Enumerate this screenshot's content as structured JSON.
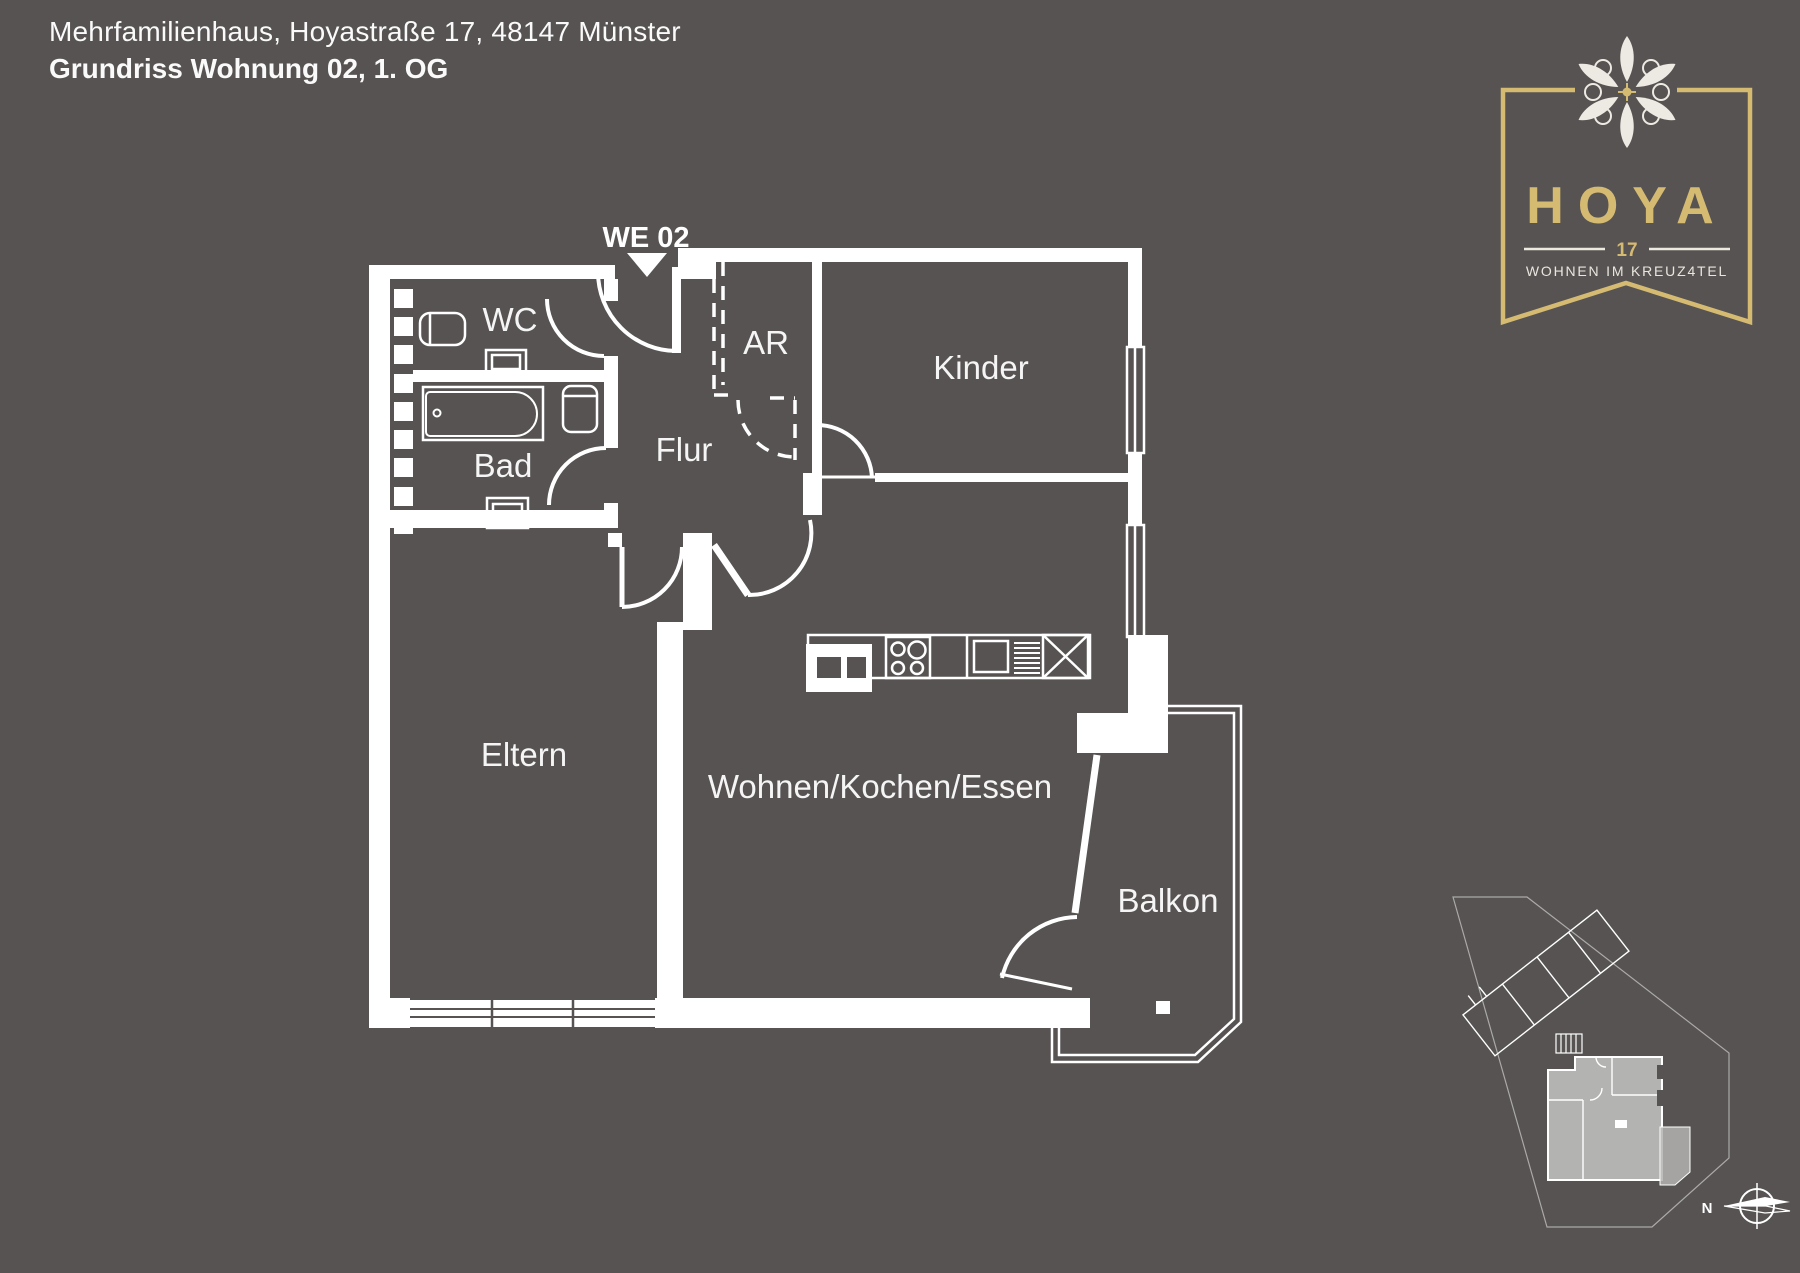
{
  "header": {
    "line1": "Mehrfamilienhaus, Hoyastraße 17, 48147 Münster",
    "line2": "Grundriss Wohnung 02, 1. OG"
  },
  "logo": {
    "name": "HOYA",
    "number": "17",
    "tagline": "WOHNEN IM KREUZ4TEL",
    "flower_icon": "hoya-flower-icon"
  },
  "plan": {
    "unit_label": "WE 02",
    "rooms": {
      "wc": "WC",
      "bad": "Bad",
      "flur": "Flur",
      "ar": "AR",
      "kinder": "Kinder",
      "eltern": "Eltern",
      "wohnen": "Wohnen/Kochen/Essen",
      "balkon": "Balkon"
    }
  },
  "minimap": {
    "north_label": "N"
  },
  "colors": {
    "background": "#565352",
    "plan_line": "#ffffff",
    "label_text": "#f5f5f5",
    "logo_gold": "#d5ba72",
    "logo_cream": "#edeae3",
    "minimap_highlight": "#b3b3b1"
  }
}
